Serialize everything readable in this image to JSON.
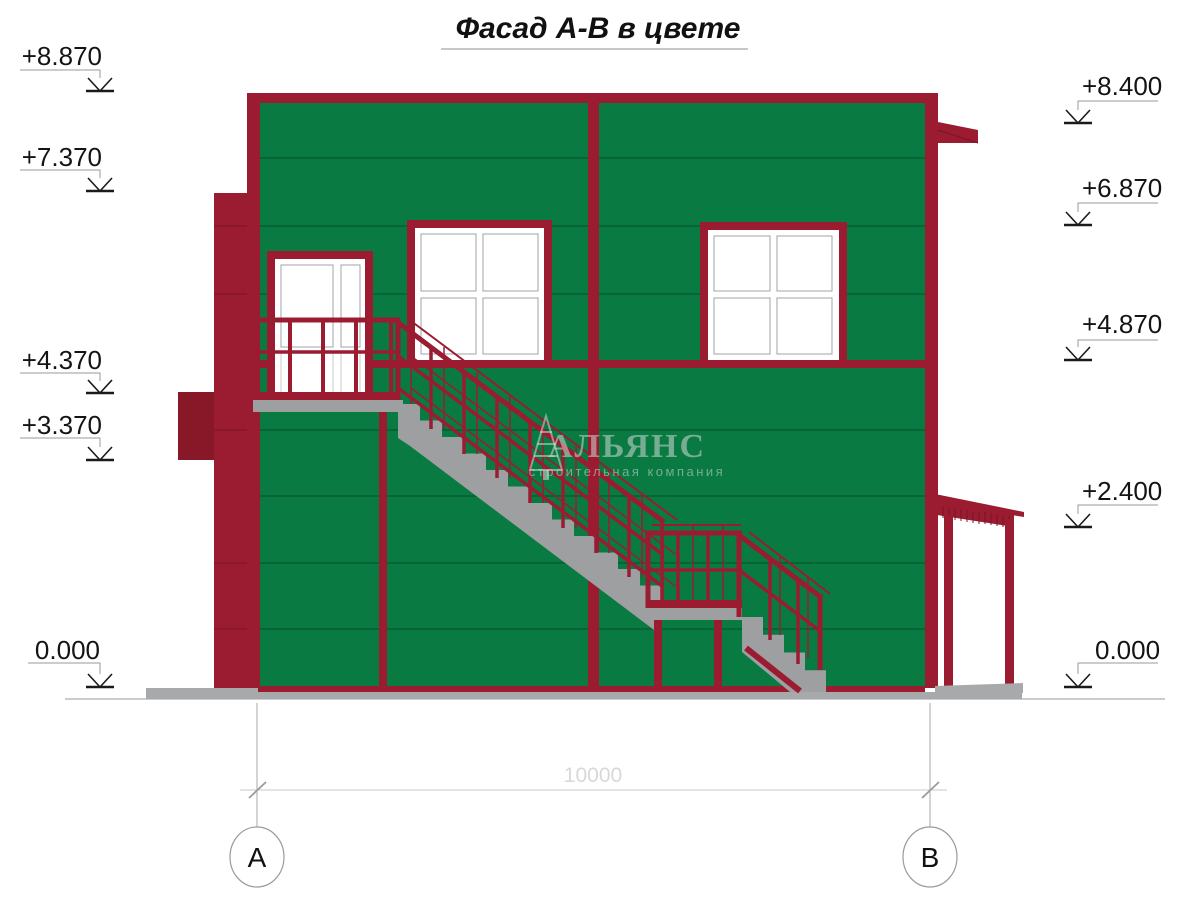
{
  "title": "Фасад А-В в цвете",
  "watermark": {
    "name": "АЛЬЯНС",
    "tagline": "строительная компания"
  },
  "levels": {
    "left": [
      {
        "value": "+8.870"
      },
      {
        "value": "+7.370"
      },
      {
        "value": "+4.370"
      },
      {
        "value": "+3.370"
      },
      {
        "value": "0.000"
      }
    ],
    "right": [
      {
        "value": "+8.400"
      },
      {
        "value": "+6.870"
      },
      {
        "value": "+4.870"
      },
      {
        "value": "+2.400"
      },
      {
        "value": "0.000"
      }
    ]
  },
  "dimension": {
    "value": "10000"
  },
  "axes": [
    {
      "label": "А"
    },
    {
      "label": "В"
    }
  ],
  "colors": {
    "facade_green": "#087a42",
    "trim_red": "#9b1c31",
    "trim_red_dark": "#7a1426",
    "concrete_gray": "#9d9fa1",
    "glass_light": "#f2f3f4",
    "glass_dark": "#8f9599",
    "drawing_gray": "#c9c9c9"
  }
}
